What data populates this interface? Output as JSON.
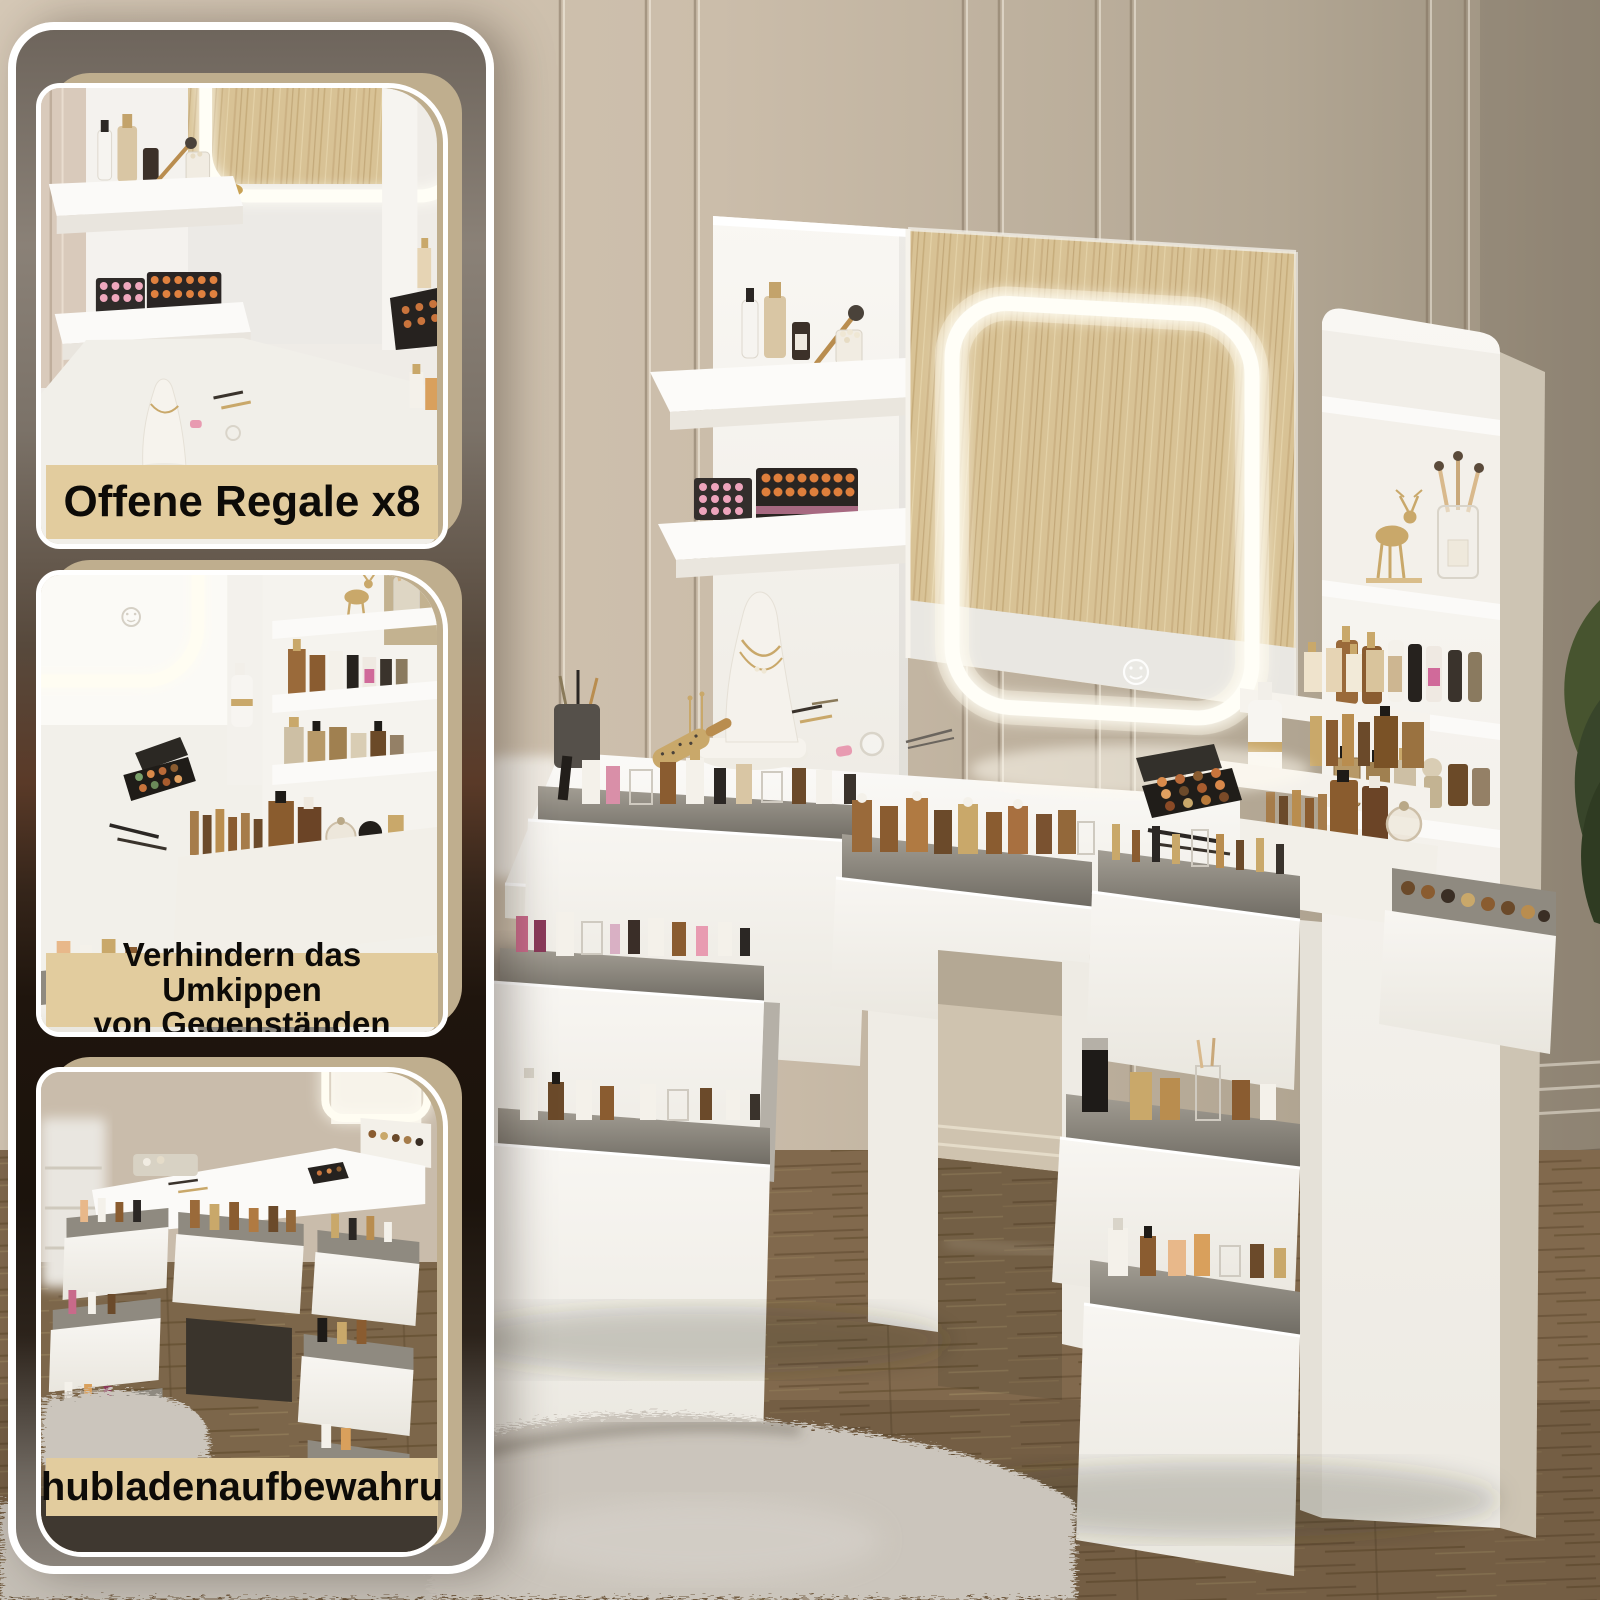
{
  "cards": [
    {
      "name": "open-shelves",
      "lines": [
        "Offene Regale x8"
      ]
    },
    {
      "name": "anti-tip",
      "lines": [
        "Verhindern das Umkippen",
        "von Gegenständen"
      ]
    },
    {
      "name": "drawer-storage",
      "lines": [
        "Schubladenaufbewahrung"
      ]
    }
  ],
  "icons": [
    {
      "name": "touch-control-icon",
      "glyph": "smiley-circle"
    }
  ],
  "theme": {
    "band_bg": "#e2cc9e",
    "card_backdrop": "#bfae8e",
    "border_white": "#ffffff",
    "wall": "#cdbfad",
    "wall_dark": "#9a8f7d",
    "floor_wood": "#8d7456",
    "furniture_white": "#f6f4f0",
    "led_glow": "#fff8e7",
    "rug_grey": "#cbc5bc",
    "accent_gold": "#c9a86a",
    "plant_green": "#47542f"
  }
}
